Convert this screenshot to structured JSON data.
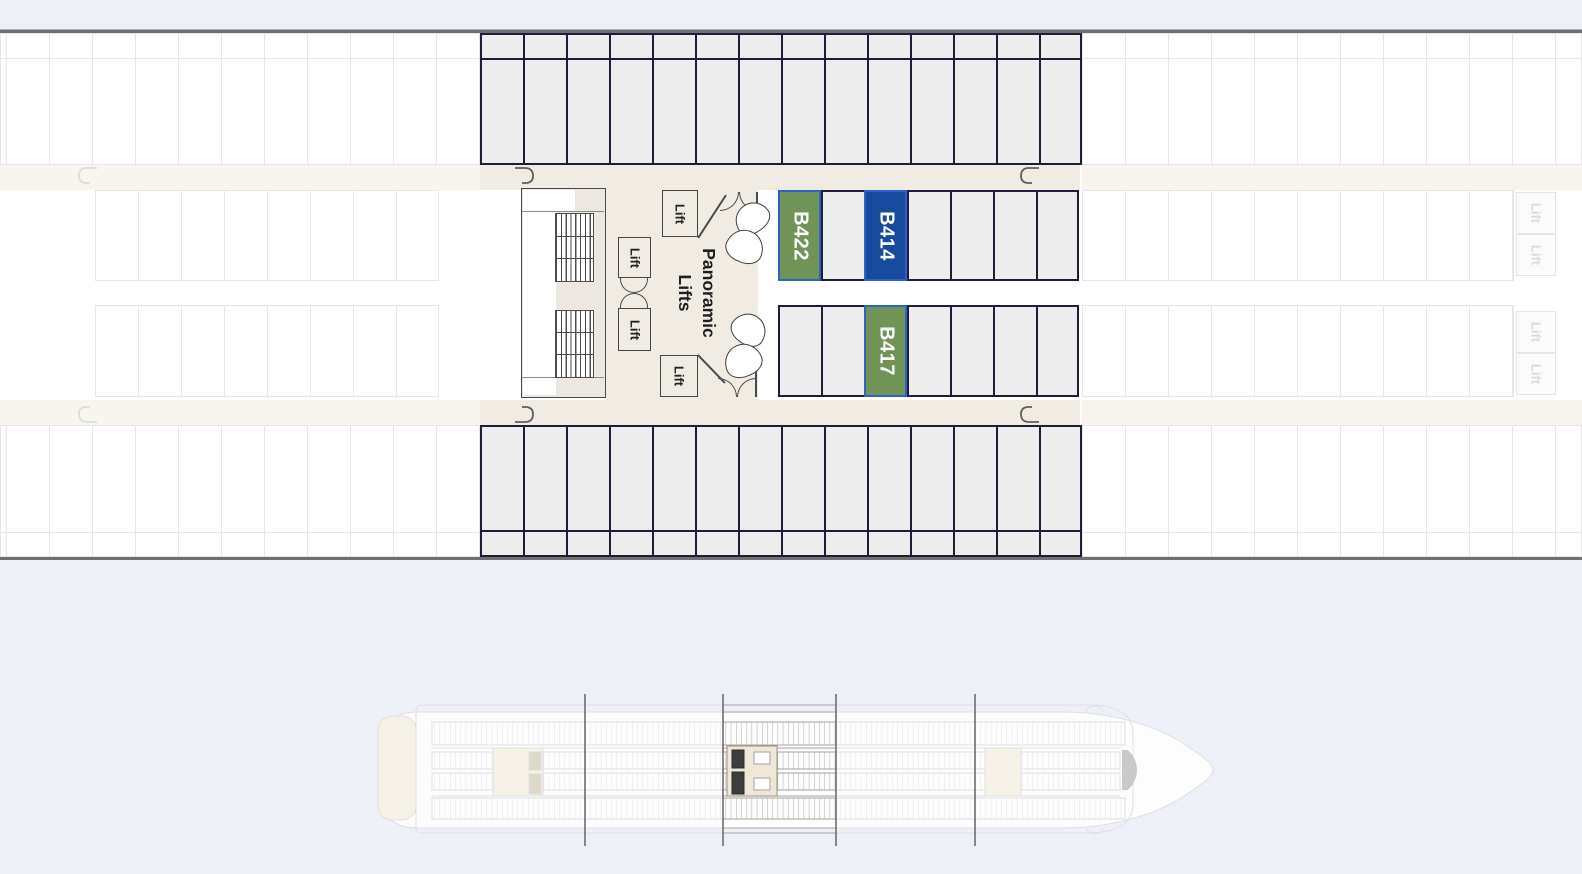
{
  "colors": {
    "page_bg": "#edf1f7",
    "plan_bg": "#ffffff",
    "corridor": "#f1ece3",
    "corridor_faded": "#f8f5ef",
    "cabin_fill": "#ededed",
    "cabin_border": "#1d1d38",
    "faded_line": "#e6e6ea",
    "selected_green": "#6f9455",
    "selected_blue": "#17499c",
    "selection_outline": "#2e63c6",
    "wall": "#4a4a4a",
    "hull_line": "#707070",
    "minimap_section_line": "#6d6d6d"
  },
  "deck_plan": {
    "cabins": {
      "b422": {
        "label": "B422",
        "highlight": "green"
      },
      "b414": {
        "label": "B414",
        "highlight": "blue"
      },
      "b417": {
        "label": "B417",
        "highlight": "green"
      }
    },
    "lobby": {
      "panoramic_line1": "Panoramic",
      "panoramic_line2": "Lifts",
      "lifts": [
        "Lift",
        "Lift",
        "Lift",
        "Lift"
      ]
    },
    "adjacent_section_lifts": [
      "Lift",
      "Lift",
      "Lift",
      "Lift"
    ]
  },
  "minimap": {
    "type": "ship-overview",
    "section_divider_count": 4,
    "highlighted_section": "midship"
  }
}
